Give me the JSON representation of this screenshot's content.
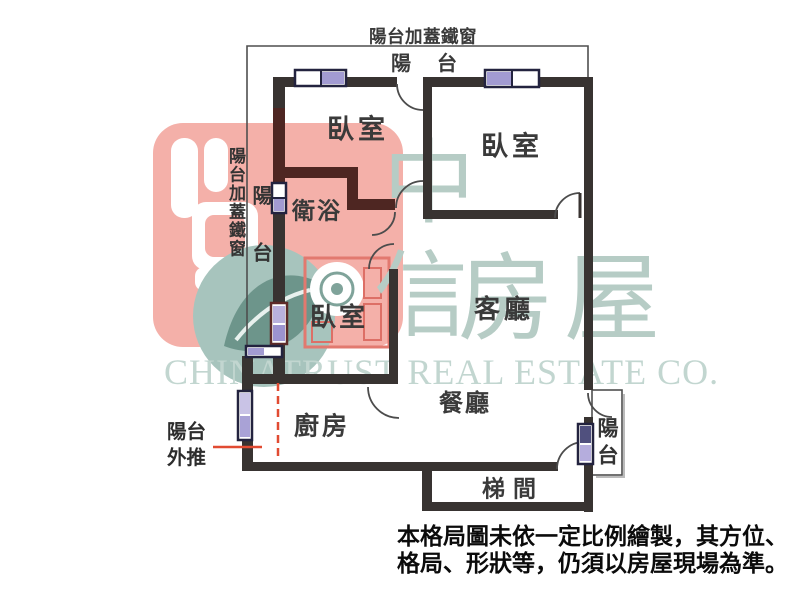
{
  "header": {
    "top_cover_label": "陽台加蓋鐵窗"
  },
  "rooms": {
    "bedroom_top_left": "臥室",
    "bedroom_top_right": "臥室",
    "bathroom": "衛浴",
    "bedroom_middle": "臥室",
    "living_room": "客廳",
    "kitchen": "廚房",
    "dining_room": "餐廳",
    "stairwell": "梯間"
  },
  "balconies": {
    "top_label": "陽台",
    "left_label": "陽台",
    "right_label": "陽台",
    "left_cover_label": "陽台加蓋鐵窗",
    "pushed_out_line1": "陽台",
    "pushed_out_line2": "外推"
  },
  "watermark": {
    "char1": "中",
    "char2": "信",
    "char3": "房",
    "char4": "屋",
    "company_en": "CHINATRUST REAL ESTATE CO."
  },
  "disclaimer": {
    "line1": "本格局圖未依一定比例繪製，其方位、",
    "line2": "格局、形狀等，仍須以房屋現場為準。"
  },
  "colors": {
    "wall": "#383331",
    "bathroom_wall": "#4e2622",
    "window_frame": "#23233f",
    "annotation_red": "#e14b32",
    "watermark_pink": "#f4b0a9",
    "watermark_teal": "#b6ccc5"
  }
}
